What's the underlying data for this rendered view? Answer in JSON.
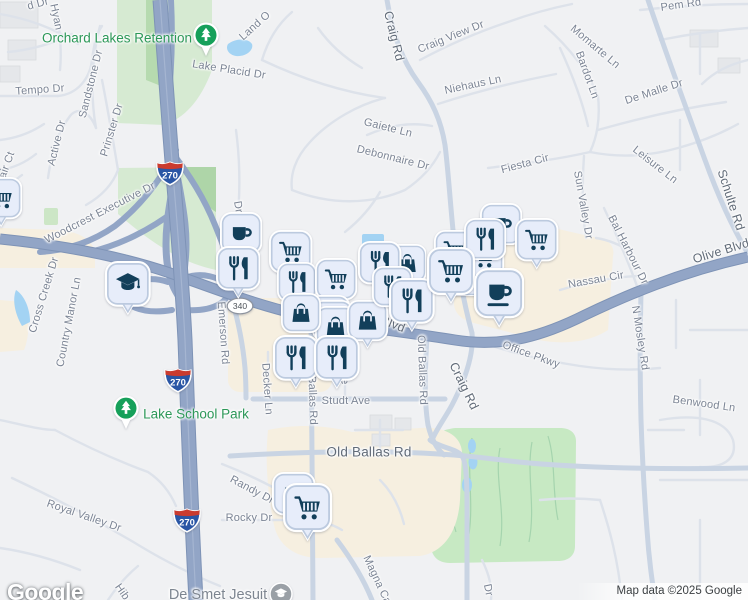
{
  "map": {
    "attribution": "Map data ©2025 Google",
    "logo_text": "Google",
    "colors": {
      "background": "#f0f1f3",
      "highway": "#92a5c6",
      "highway_casing": "#7e93b6",
      "road_medium": "#c9d4e3",
      "road_minor": "#dde2ea",
      "water": "#a3d3f3",
      "park_green": "#d6ead2",
      "forest_green": "#b6daaf",
      "golf_green": "#c7e9c3",
      "commercial_beige": "#f6efe0",
      "pin_fill": "#e7edfa",
      "pin_border": "#bccadf",
      "pin_glyph": "#123f5a",
      "park_pin_green": "#16a05a",
      "label_gray": "#7b8494",
      "park_label_green": "#2c9858"
    },
    "shields": [
      {
        "type": "interstate",
        "label": "270",
        "x": 170,
        "y": 173
      },
      {
        "type": "interstate",
        "label": "270",
        "x": 178,
        "y": 380
      },
      {
        "type": "interstate",
        "label": "270",
        "x": 187,
        "y": 520
      },
      {
        "type": "state-oval",
        "label": "340",
        "x": 240,
        "y": 306
      }
    ],
    "place_labels": [
      {
        "text": "Orchard Lakes Retention",
        "x": 117,
        "y": 38,
        "cls": "green"
      },
      {
        "text": "Lake School Park",
        "x": 196,
        "y": 414,
        "cls": "green"
      },
      {
        "text": "De Smet Jesuit",
        "x": 218,
        "y": 595,
        "cls": "gray"
      }
    ],
    "park_pins": [
      {
        "icon": "tree-icon",
        "x": 206,
        "y": 36
      },
      {
        "icon": "tree-icon",
        "x": 126,
        "y": 409
      }
    ],
    "poi_markers": [
      {
        "icon": "school-circle-icon",
        "x": 281,
        "y": 594
      }
    ],
    "street_labels": [
      {
        "text": "d Dr",
        "x": 38,
        "y": 4,
        "rot": -15
      },
      {
        "text": "Hyan",
        "x": 56,
        "y": 17,
        "rot": 78
      },
      {
        "text": "Lake Placid Dr",
        "x": 229,
        "y": 70,
        "rot": 9
      },
      {
        "text": "Tempo Dr",
        "x": 40,
        "y": 90,
        "rot": -4
      },
      {
        "text": "Sandstone Dr",
        "x": 91,
        "y": 84,
        "rot": -76
      },
      {
        "text": "Active Dr",
        "x": 57,
        "y": 143,
        "rot": -76
      },
      {
        "text": "Prinster Dr",
        "x": 112,
        "y": 130,
        "rot": -73
      },
      {
        "text": "air Ct",
        "x": 7,
        "y": 165,
        "rot": -70
      },
      {
        "text": "Land O",
        "x": 255,
        "y": 26,
        "rot": -42
      },
      {
        "text": "Craig Rd",
        "x": 394,
        "y": 36,
        "rot": 76,
        "cls": "major"
      },
      {
        "text": "Craig View Dr",
        "x": 451,
        "y": 37,
        "rot": -22
      },
      {
        "text": "Niehaus Ln",
        "x": 473,
        "y": 85,
        "rot": -12
      },
      {
        "text": "Gaiete Ln",
        "x": 388,
        "y": 128,
        "rot": 14
      },
      {
        "text": "Debonnaire Dr",
        "x": 393,
        "y": 158,
        "rot": 14
      },
      {
        "text": "Pem Rd",
        "x": 681,
        "y": 5,
        "rot": -8
      },
      {
        "text": "Momarte Ln",
        "x": 595,
        "y": 47,
        "rot": 40
      },
      {
        "text": "Bardot Ln",
        "x": 587,
        "y": 75,
        "rot": 70
      },
      {
        "text": "De Malle Dr",
        "x": 654,
        "y": 92,
        "rot": -18
      },
      {
        "text": "Leisure Ln",
        "x": 655,
        "y": 165,
        "rot": 38
      },
      {
        "text": "Fiesta Cir",
        "x": 525,
        "y": 164,
        "rot": -15
      },
      {
        "text": "Sun Valley Dr",
        "x": 583,
        "y": 205,
        "rot": 80
      },
      {
        "text": "Schulte Rd",
        "x": 731,
        "y": 200,
        "rot": 72,
        "cls": "major"
      },
      {
        "text": "Olive Blvd",
        "x": 721,
        "y": 251,
        "rot": -17,
        "cls": "major"
      },
      {
        "text": "Bal Harbour Dr",
        "x": 628,
        "y": 250,
        "rot": 63
      },
      {
        "text": "Nassau Cir",
        "x": 596,
        "y": 280,
        "rot": -10
      },
      {
        "text": "N Mosley Rd",
        "x": 640,
        "y": 338,
        "rot": 81
      },
      {
        "text": "Woodcrest Executive Dr",
        "x": 100,
        "y": 213,
        "rot": -27
      },
      {
        "text": "Cross Creek Dr",
        "x": 44,
        "y": 295,
        "rot": -73
      },
      {
        "text": "Country Manor Ln",
        "x": 69,
        "y": 322,
        "rot": -79
      },
      {
        "text": "Emerson Rd",
        "x": 223,
        "y": 333,
        "rot": 86
      },
      {
        "text": "Dr",
        "x": 238,
        "y": 207,
        "rot": 80
      },
      {
        "text": "Blvd",
        "x": 393,
        "y": 324,
        "rot": 22,
        "cls": "major"
      },
      {
        "text": "Old Ballas Rd",
        "x": 312,
        "y": 390,
        "rot": 88
      },
      {
        "text": "Old Ballas Rd",
        "x": 422,
        "y": 370,
        "rot": 88
      },
      {
        "text": "Studt Ave",
        "x": 346,
        "y": 401,
        "rot": 0
      },
      {
        "text": "Old Ballas Rd",
        "x": 369,
        "y": 452,
        "rot": 0,
        "cls": "major",
        "size": 13.5
      },
      {
        "text": "Craig Rd",
        "x": 464,
        "y": 386,
        "rot": 64,
        "cls": "major"
      },
      {
        "text": "Office Pkwy",
        "x": 531,
        "y": 355,
        "rot": 20
      },
      {
        "text": "Benwood Ln",
        "x": 704,
        "y": 404,
        "rot": 8
      },
      {
        "text": "Decker Ln",
        "x": 267,
        "y": 389,
        "rot": 86
      },
      {
        "text": "Ave",
        "x": 344,
        "y": 375,
        "rot": 86
      },
      {
        "text": "Royal Valley Dr",
        "x": 84,
        "y": 516,
        "rot": 19
      },
      {
        "text": "Randy Dr",
        "x": 252,
        "y": 490,
        "rot": 28
      },
      {
        "text": "Rocky Dr",
        "x": 249,
        "y": 518,
        "rot": 0
      },
      {
        "text": "Magna Ca",
        "x": 377,
        "y": 580,
        "rot": 65
      },
      {
        "text": "Hib",
        "x": 122,
        "y": 592,
        "rot": 55
      },
      {
        "text": "Dr",
        "x": 488,
        "y": 590,
        "rot": 78
      }
    ],
    "poi_pins": [
      {
        "icon": "cart-icon",
        "x": 1,
        "y": 198,
        "w": 37,
        "pointer": true
      },
      {
        "icon": "school-icon",
        "x": 128,
        "y": 284,
        "w": 40,
        "pointer": true
      },
      {
        "icon": "coffee-icon",
        "x": 241,
        "y": 233,
        "w": 37,
        "pointer": false
      },
      {
        "icon": "restaurant-icon",
        "x": 238,
        "y": 268,
        "w": 39,
        "pointer": true
      },
      {
        "icon": "cart-icon",
        "x": 291,
        "y": 252,
        "w": 38,
        "pointer": false
      },
      {
        "icon": "restaurant-icon",
        "x": 297,
        "y": 282,
        "w": 35,
        "pointer": false
      },
      {
        "icon": "cart-icon",
        "x": 336,
        "y": 279,
        "w": 37,
        "pointer": false
      },
      {
        "icon": "pin-blank",
        "x": 330,
        "y": 316,
        "w": 36,
        "pointer": false
      },
      {
        "icon": "pin-blank",
        "x": 333,
        "y": 321,
        "w": 36,
        "pointer": false
      },
      {
        "icon": "bag-icon",
        "x": 336,
        "y": 327,
        "w": 36,
        "pointer": false
      },
      {
        "icon": "bag-icon",
        "x": 301,
        "y": 313,
        "w": 35,
        "pointer": false
      },
      {
        "icon": "bag-icon",
        "x": 368,
        "y": 321,
        "w": 36,
        "pointer": true
      },
      {
        "icon": "bag-icon",
        "x": 407,
        "y": 263,
        "w": 34,
        "pointer": false
      },
      {
        "icon": "restaurant-icon",
        "x": 380,
        "y": 263,
        "w": 38,
        "pointer": false
      },
      {
        "icon": "restaurant-icon",
        "x": 393,
        "y": 287,
        "w": 36,
        "pointer": false
      },
      {
        "icon": "restaurant-icon",
        "x": 412,
        "y": 301,
        "w": 40,
        "pointer": true
      },
      {
        "icon": "restaurant-icon",
        "x": 296,
        "y": 358,
        "w": 40,
        "pointer": true
      },
      {
        "icon": "restaurant-icon",
        "x": 337,
        "y": 358,
        "w": 40,
        "pointer": true
      },
      {
        "icon": "coffee-icon",
        "x": 501,
        "y": 224,
        "w": 37,
        "pointer": false
      },
      {
        "icon": "cart-icon",
        "x": 455,
        "y": 251,
        "w": 36,
        "pointer": false
      },
      {
        "icon": "coffee-icon",
        "x": 465,
        "y": 277,
        "w": 34,
        "pointer": false
      },
      {
        "icon": "cart-icon",
        "x": 484,
        "y": 258,
        "w": 36,
        "pointer": false
      },
      {
        "icon": "restaurant-icon",
        "x": 485,
        "y": 239,
        "w": 37,
        "pointer": false
      },
      {
        "icon": "cart-icon",
        "x": 451,
        "y": 271,
        "w": 42,
        "pointer": true
      },
      {
        "icon": "cart-icon",
        "x": 537,
        "y": 240,
        "w": 38,
        "pointer": true
      },
      {
        "icon": "coffee-saucer-icon",
        "x": 499,
        "y": 293,
        "w": 44,
        "pointer": true
      },
      {
        "icon": "coffee-icon",
        "x": 294,
        "y": 494,
        "w": 38,
        "pointer": false
      },
      {
        "icon": "cart-icon",
        "x": 308,
        "y": 508,
        "w": 43,
        "pointer": true
      }
    ]
  }
}
